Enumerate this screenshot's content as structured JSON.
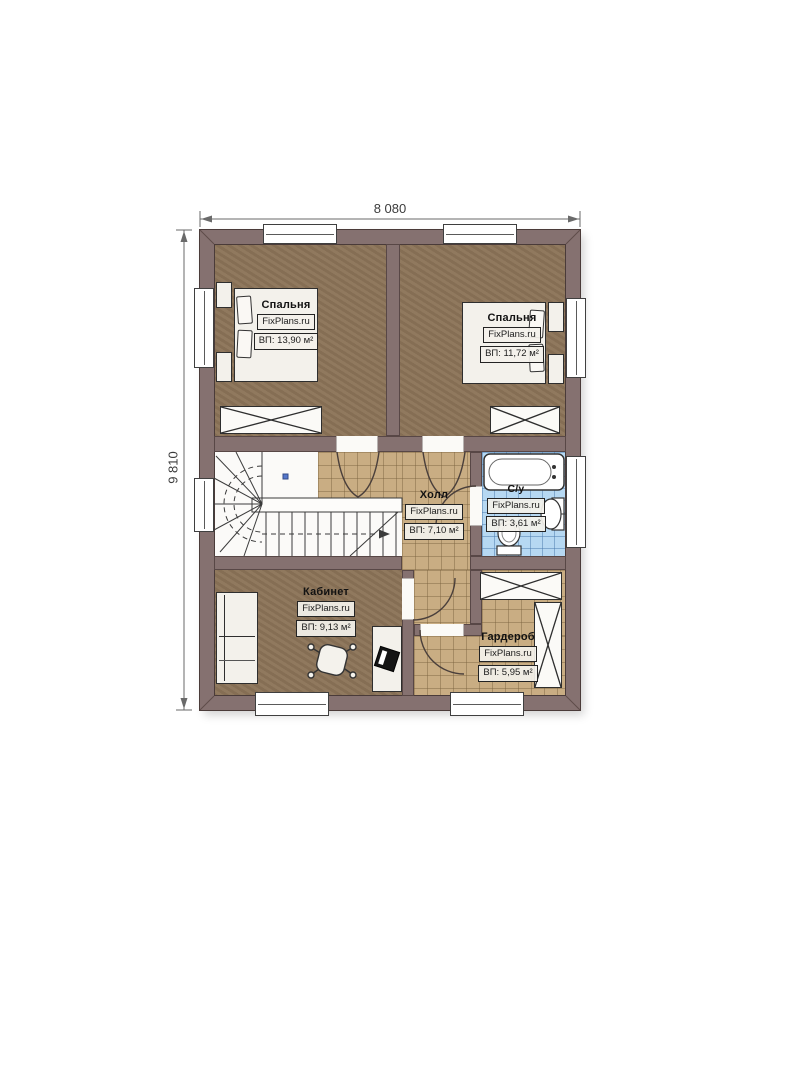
{
  "dimensions": {
    "width": "8 080",
    "height": "9 810"
  },
  "branding": {
    "watermark": "FixPlans.ru"
  },
  "rooms": [
    {
      "key": "bedroom-left",
      "name": "Спальня",
      "watermark": "FixPlans.ru",
      "area": "ВП: 13,90 м²"
    },
    {
      "key": "bedroom-right",
      "name": "Спальня",
      "watermark": "FixPlans.ru",
      "area": "ВП: 11,72 м²"
    },
    {
      "key": "hall",
      "name": "Холл",
      "watermark": "FixPlans.ru",
      "area": "ВП: 7,10 м²"
    },
    {
      "key": "bathroom",
      "name": "С/у",
      "watermark": "FixPlans.ru",
      "area": "ВП: 3,61 м²"
    },
    {
      "key": "office",
      "name": "Кабинет",
      "watermark": "FixPlans.ru",
      "area": "ВП: 9,13 м²"
    },
    {
      "key": "wardrobe",
      "name": "Гардероб",
      "watermark": "FixPlans.ru",
      "area": "ВП: 5,95 м²"
    }
  ],
  "colors": {
    "wall": "#857170",
    "floor_wood": "#8c7458",
    "tile_tan": "#c9ad83",
    "tile_blue": "#b6d8f2",
    "line": "#3b3b3b"
  }
}
